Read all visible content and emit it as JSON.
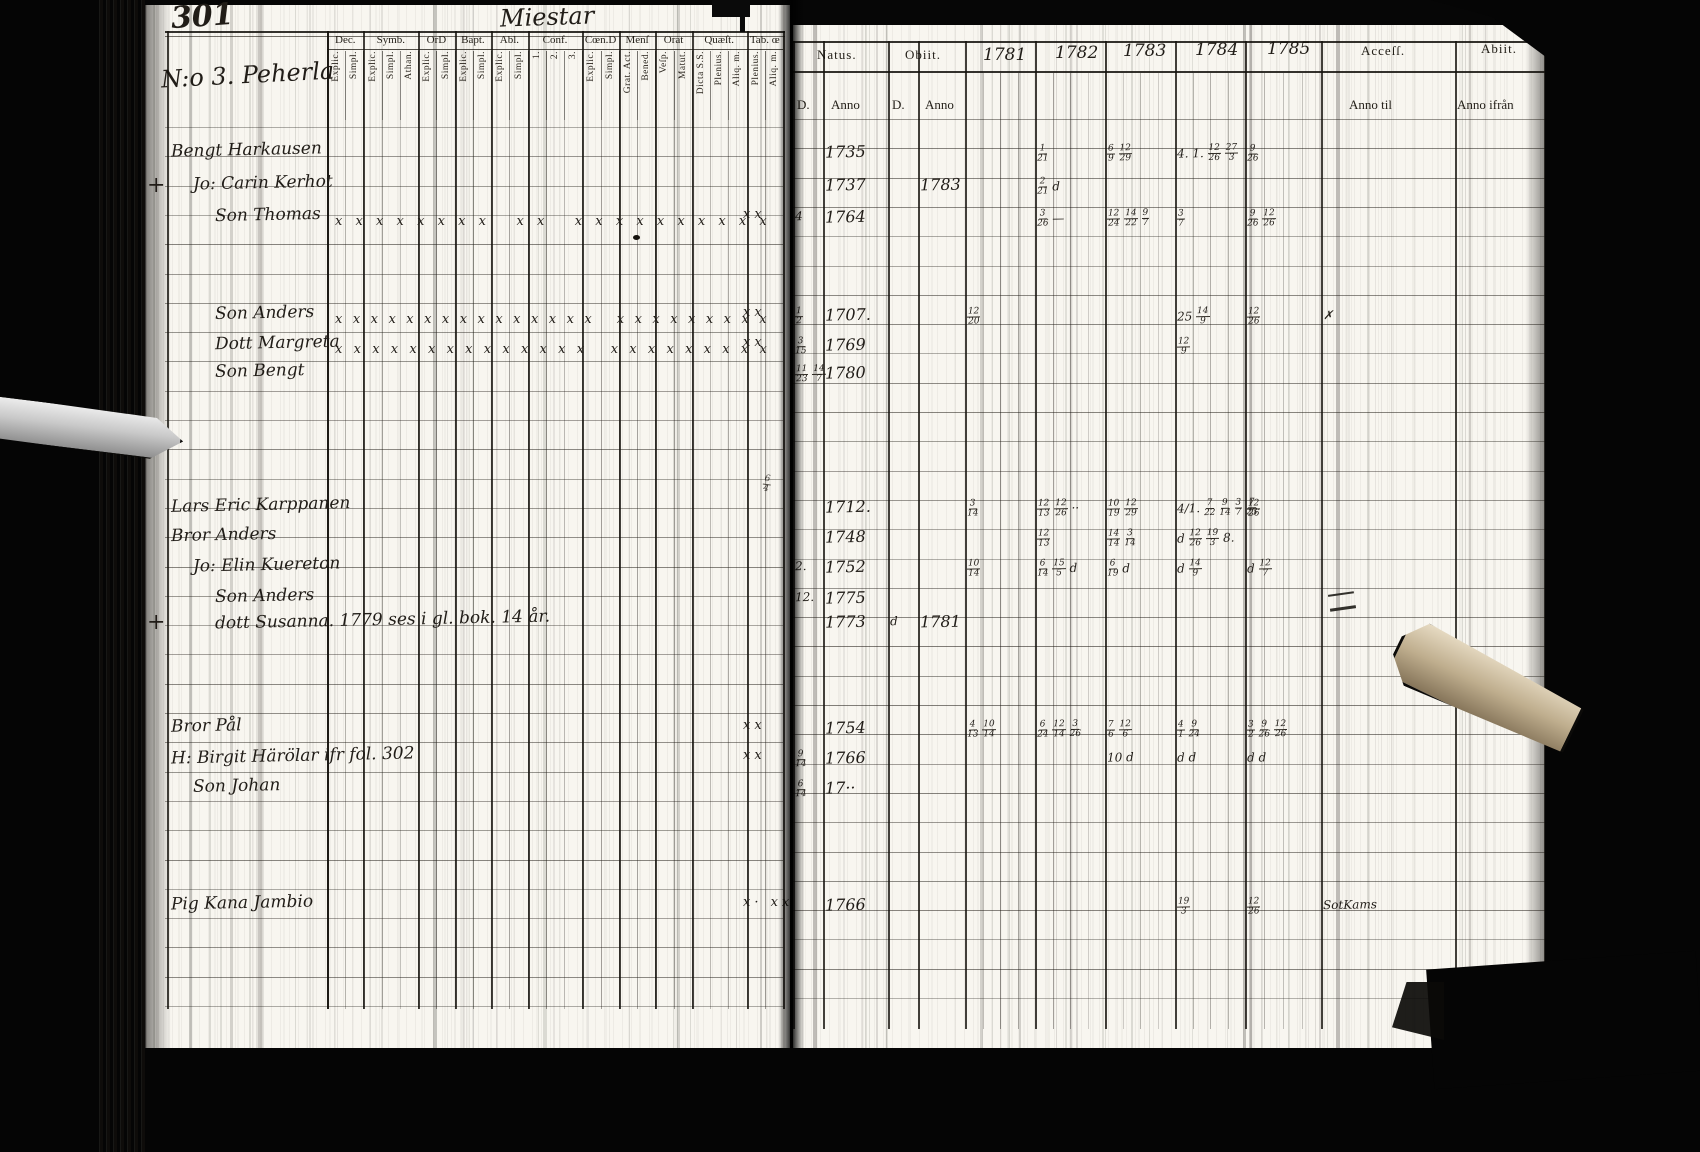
{
  "scan": {
    "page_number": "301",
    "title": "Miestar"
  },
  "left_page": {
    "section_label": "N:o 3. Peherla",
    "header_groups": [
      {
        "label": "Dec.",
        "subs": [
          "Explic.",
          "Simpl."
        ]
      },
      {
        "label": "Symb.",
        "subs": [
          "Explic.",
          "Simpl.",
          "Athan."
        ]
      },
      {
        "label": "OrD",
        "subs": [
          "Explic.",
          "Simpl."
        ]
      },
      {
        "label": "Bapt.",
        "subs": [
          "Explic.",
          "Simpl."
        ]
      },
      {
        "label": "Abl.",
        "subs": [
          "Explic.",
          "Simpl."
        ]
      },
      {
        "label": "Conf.",
        "subs": [
          "1.",
          "2.",
          "3."
        ]
      },
      {
        "label": "Cœn.D",
        "subs": [
          "Explic.",
          "Simpl."
        ]
      },
      {
        "label": "Menſ",
        "subs": [
          "Grat. Act.",
          "Bened."
        ]
      },
      {
        "label": "Orat",
        "subs": [
          "Veſp.",
          "Matut."
        ]
      },
      {
        "label": "Quæſt.",
        "subs": [
          "Dicta S.S.",
          "Plenius.",
          "Aliq. m."
        ]
      },
      {
        "label": "Tab. œ",
        "subs": [
          "Plenius.",
          "Aliq. m."
        ]
      }
    ]
  },
  "right_page": {
    "natus": {
      "label": "Natus.",
      "d": "D.",
      "anno": "Anno"
    },
    "obiit": {
      "label": "Obiit.",
      "d": "D.",
      "anno": "Anno"
    },
    "years": [
      "1781",
      "1782",
      "1783",
      "1784",
      "1785"
    ],
    "accessit": {
      "label": "Acceſſ.",
      "sub": "Anno til"
    },
    "abiit": {
      "label": "Abiit.",
      "sub": "Anno ifrån"
    }
  },
  "rows": [
    {
      "y": 142,
      "margin": "",
      "indent": 0,
      "name": "Bengt Harkausen",
      "marks": "",
      "edge_marks": "",
      "natus_d": "",
      "natus": "1735",
      "obiit_d": "",
      "obiit": "",
      "y1781": "",
      "y1782": "1/21",
      "y1783": "6/9 12/29",
      "y1784": "4. 1. 12/26 27/3",
      "y1785": "9/26",
      "accessit": "",
      "abiit": ""
    },
    {
      "y": 175,
      "margin": "+",
      "indent": 1,
      "name": "Jo: Carin Kerhot",
      "marks": "",
      "edge_marks": "",
      "natus_d": "",
      "natus": "1737",
      "obiit_d": "",
      "obiit": "1783",
      "y1781": "",
      "y1782": "2/21 d",
      "y1783": "",
      "y1784": "",
      "y1785": "",
      "accessit": "",
      "abiit": ""
    },
    {
      "y": 207,
      "margin": "",
      "indent": 2,
      "name": "Son Thomas",
      "marks": "xxxxxxxx xx xxxxxxxxxx",
      "edge_marks": "xx",
      "natus_d": "4",
      "natus": "1764",
      "obiit_d": "",
      "obiit": "",
      "y1781": "",
      "y1782": "3/26 —",
      "y1783": "12/24 14/22 9/7",
      "y1784": "3/7",
      "y1785": "9/26 12/26",
      "accessit": "",
      "abiit": ""
    },
    {
      "y": 305,
      "margin": "",
      "indent": 2,
      "name": "Son Anders",
      "marks": "xxxxxxxxxxxxxxx xxxxxxxxx",
      "edge_marks": "xx",
      "natus_d": "1/2",
      "natus": "1707.",
      "obiit_d": "",
      "obiit": "",
      "y1781": "12/20",
      "y1782": "",
      "y1783": "",
      "y1784": "25 14/9",
      "y1785": "12/26",
      "accessit": "✗",
      "abiit": ""
    },
    {
      "y": 335,
      "margin": "",
      "indent": 2,
      "name": "Dott Margreta",
      "marks": "xxxxxxxxxxxxxx xxxxxxxxx",
      "edge_marks": "xx",
      "natus_d": "3/15",
      "natus": "1769",
      "obiit_d": "",
      "obiit": "",
      "y1781": "",
      "y1782": "",
      "y1783": "",
      "y1784": "12/9",
      "y1785": "",
      "accessit": "",
      "abiit": ""
    },
    {
      "y": 363,
      "margin": "",
      "indent": 2,
      "name": "Son Bengt",
      "marks": "",
      "edge_marks": "",
      "natus_d": "11/23 14/7",
      "natus": "1780",
      "obiit_d": "",
      "obiit": "",
      "y1781": "",
      "y1782": "",
      "y1783": "",
      "y1784": "",
      "y1785": "",
      "accessit": "",
      "abiit": ""
    },
    {
      "y": 497,
      "margin": "",
      "indent": 0,
      "name": "Lars Eric Karppanen",
      "marks": "",
      "edge_marks": "",
      "natus_d": "",
      "natus": "1712.",
      "obiit_d": "",
      "obiit": "",
      "y1781": "3/14",
      "y1782": "12/13 12/26 ··",
      "y1783": "10/19 12/29",
      "y1784": "4/1. 7/22 9/14 3/7 7/23",
      "y1785": "12/26",
      "accessit": "",
      "abiit": ""
    },
    {
      "y": 527,
      "margin": "",
      "indent": 0,
      "name": "Bror Anders",
      "marks": "",
      "edge_marks": "",
      "natus_d": "",
      "natus": "1748",
      "obiit_d": "",
      "obiit": "",
      "y1781": "",
      "y1782": "12/13",
      "y1783": "14/14 3/14",
      "y1784": "d 12/26 19/3 8.",
      "y1785": "",
      "accessit": "",
      "abiit": ""
    },
    {
      "y": 557,
      "margin": "",
      "indent": 1,
      "name": "Jo: Elin Kuereton",
      "marks": "",
      "edge_marks": "",
      "natus_d": "2.",
      "natus": "1752",
      "obiit_d": "",
      "obiit": "",
      "y1781": "10/14",
      "y1782": "6/14 15/5 d",
      "y1783": "6/19 d",
      "y1784": "d 14/9",
      "y1785": "d 12/7",
      "accessit": "",
      "abiit": ""
    },
    {
      "y": 588,
      "margin": "",
      "indent": 2,
      "name": "Son Anders",
      "marks": "",
      "edge_marks": "",
      "natus_d": "12.",
      "natus": "1775",
      "obiit_d": "",
      "obiit": "",
      "y1781": "",
      "y1782": "",
      "y1783": "",
      "y1784": "",
      "y1785": "",
      "accessit": "",
      "abiit": ""
    },
    {
      "y": 612,
      "margin": "+",
      "indent": 2,
      "name": "dott Susanna. 1779  ses i gl. bok. 14 år.",
      "marks": "",
      "edge_marks": "",
      "natus_d": "",
      "natus": "1773",
      "obiit_d": "d",
      "obiit": "1781",
      "y1781": "",
      "y1782": "",
      "y1783": "",
      "y1784": "",
      "y1785": "",
      "accessit": "",
      "abiit": ""
    },
    {
      "y": 718,
      "margin": "",
      "indent": 0,
      "name": "Bror Pål",
      "marks": "",
      "edge_marks": "xx",
      "natus_d": "",
      "natus": "1754",
      "obiit_d": "",
      "obiit": "",
      "y1781": "4/13 10/14",
      "y1782": "6/24 12/14 3/26",
      "y1783": "7/6 12/6",
      "y1784": "4/1 9/24",
      "y1785": "3/2 9/26 12/26",
      "accessit": "",
      "abiit": ""
    },
    {
      "y": 748,
      "margin": "",
      "indent": 0,
      "name": "H: Birgit Härölar  ifr fol. 302",
      "marks": "",
      "edge_marks": "xx",
      "natus_d": "9/14",
      "natus": "1766",
      "obiit_d": "",
      "obiit": "",
      "y1781": "",
      "y1782": "",
      "y1783": "10 d",
      "y1784": "d d",
      "y1785": "d d",
      "accessit": "",
      "abiit": ""
    },
    {
      "y": 778,
      "margin": "",
      "indent": 1,
      "name": "Son Johan",
      "marks": "",
      "edge_marks": "",
      "natus_d": "6/14",
      "natus": "17··",
      "obiit_d": "",
      "obiit": "",
      "y1781": "",
      "y1782": "",
      "y1783": "",
      "y1784": "",
      "y1785": "",
      "accessit": "",
      "abiit": ""
    },
    {
      "y": 895,
      "margin": "",
      "indent": 0,
      "name": "Pig Kana Jambio",
      "marks": "",
      "edge_marks": "x· xx",
      "natus_d": "",
      "natus": "1766",
      "obiit_d": "",
      "obiit": "",
      "y1781": "",
      "y1782": "",
      "y1783": "",
      "y1784": "19/3",
      "y1785": "12/26",
      "accessit": "SotKams",
      "abiit": ""
    }
  ],
  "stray_marks": [
    {
      "text": "6/4",
      "note": "flourish-at-gutter"
    }
  ],
  "colors": {
    "paper": "#f8f6f0",
    "ink": "#211d18",
    "print": "#242019",
    "background": "#060606"
  }
}
